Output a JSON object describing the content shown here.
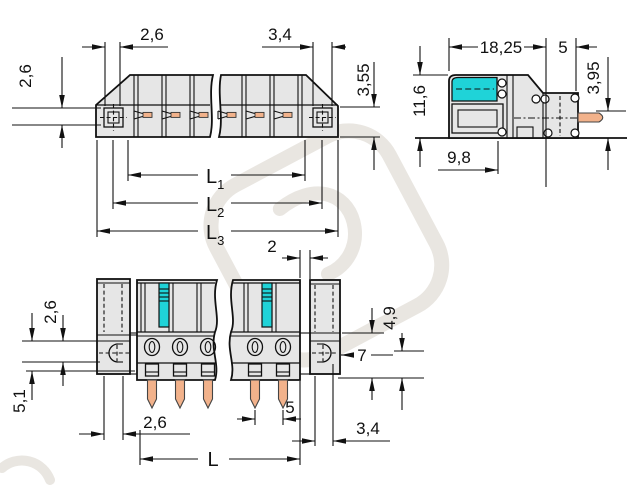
{
  "title": "connector-dimensional-drawing",
  "colors": {
    "line": "#111111",
    "body_gray": "#e6e6e6",
    "cyan": "#1fd3d8",
    "copper": "#f2b28b",
    "watermark": "#e9e6e1"
  },
  "plan_view": {
    "dim_top_left": "2,6",
    "dim_top_right": "3,4",
    "dim_side_left": "2,6",
    "dim_side_right": "3,55",
    "l1": {
      "base": "L",
      "sub": "1"
    },
    "l2": {
      "base": "L",
      "sub": "2"
    },
    "l3": {
      "base": "L",
      "sub": "3"
    }
  },
  "side_view": {
    "dim_width": "18,25",
    "dim_pin_inset": "5",
    "dim_pin_height": "3,95",
    "dim_height": "11,6",
    "dim_depth": "9,8"
  },
  "front_view": {
    "dim_gap": "2",
    "dim_upper_left": "2,6",
    "dim_lower_left": "5,1",
    "dim_flange_bottom": "2,6",
    "dim_pitch": "5",
    "dim_length": "L",
    "dim_step": "4,9",
    "dim_flange_height": "7",
    "dim_hole": "3,4"
  }
}
